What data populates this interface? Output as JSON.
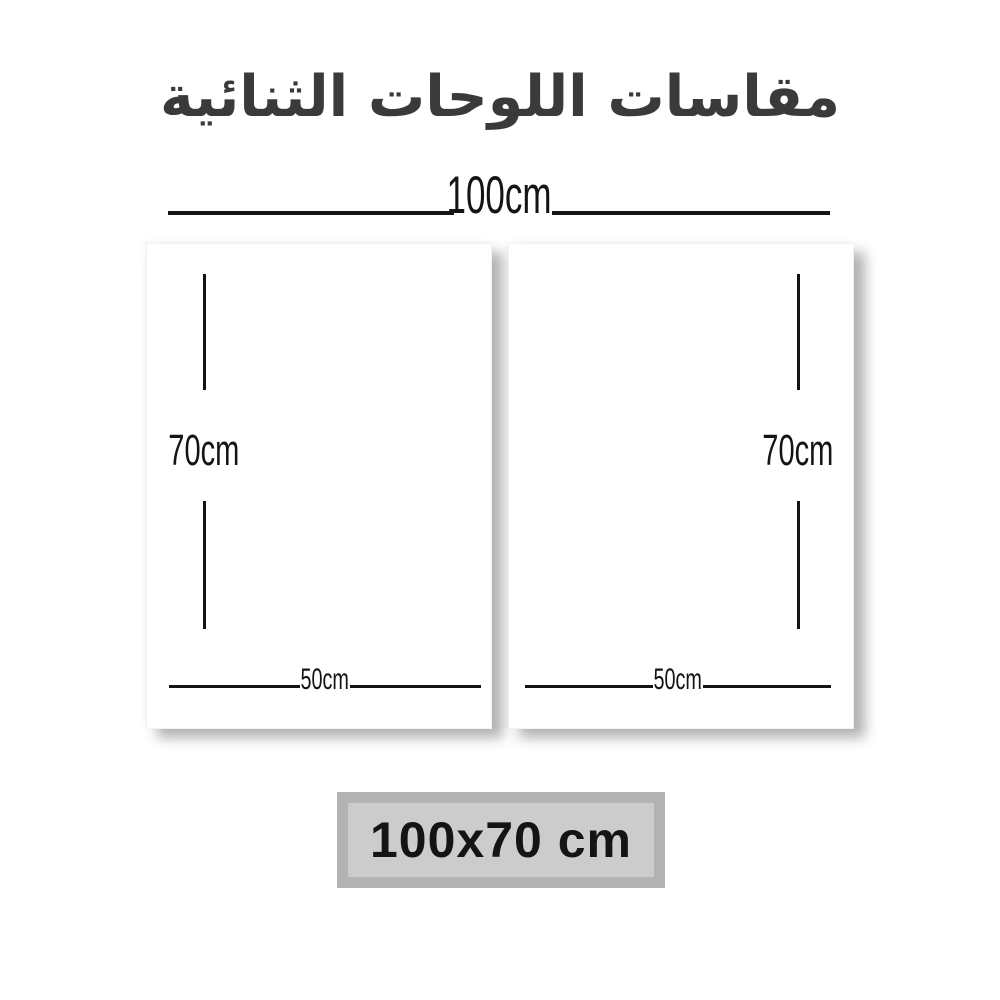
{
  "title": {
    "text": "مقاسات اللوحات الثنائية"
  },
  "dimensions": {
    "total_width_label": "100cm",
    "panels": [
      {
        "name": "left-panel",
        "height_label": "70cm",
        "width_label": "50cm"
      },
      {
        "name": "right-panel",
        "height_label": "70cm",
        "width_label": "50cm"
      }
    ]
  },
  "size_badge": {
    "label": "100x70 cm"
  },
  "colors": {
    "background": "#ffffff",
    "dimension_line": "#141414",
    "title_text": "#3a3a3c",
    "badge_outer": "#b3b3b3",
    "badge_inner": "#cccccc",
    "badge_text": "#141414"
  }
}
